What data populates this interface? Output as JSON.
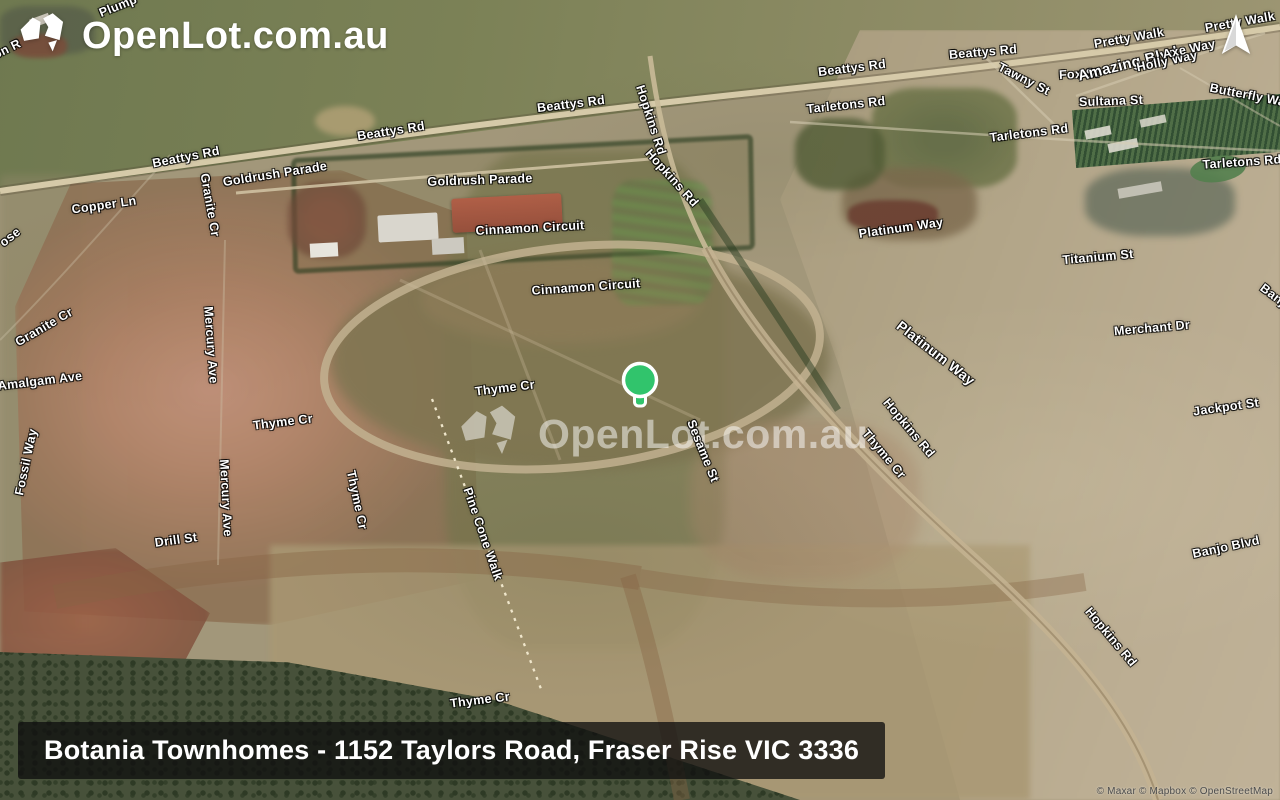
{
  "header": {
    "logo_text": "OpenLot.com.au",
    "logo_icon": "australia-map-icon"
  },
  "compass": {
    "icon": "north-arrow-icon"
  },
  "watermark": {
    "text": "OpenLot.com.au",
    "icon": "australia-map-icon"
  },
  "banner": {
    "text": "Botania Townhomes - 1152 Taylors Road, Fraser Rise VIC 3336"
  },
  "attribution": {
    "text": "© Maxar © Mapbox © OpenStreetMap"
  },
  "marker": {
    "icon": "location-marker",
    "color": "#31c46c",
    "x": 640,
    "y": 380
  },
  "map": {
    "labels": [
      {
        "text": "Plump",
        "x": 118,
        "y": 6,
        "rot": -22
      },
      {
        "text": "on R",
        "x": 7,
        "y": 49,
        "rot": -26
      },
      {
        "text": "Beattys Rd",
        "x": 186,
        "y": 157,
        "rot": -11
      },
      {
        "text": "Beattys Rd",
        "x": 391,
        "y": 131,
        "rot": -9
      },
      {
        "text": "Beattys Rd",
        "x": 571,
        "y": 104,
        "rot": -7
      },
      {
        "text": "Beattys Rd",
        "x": 852,
        "y": 68,
        "rot": -7
      },
      {
        "text": "Beattys Rd",
        "x": 983,
        "y": 52,
        "rot": -5
      },
      {
        "text": "Goldrush Parade",
        "x": 275,
        "y": 174,
        "rot": -9
      },
      {
        "text": "Goldrush Parade",
        "x": 480,
        "y": 180,
        "rot": -2
      },
      {
        "text": "Copper Ln",
        "x": 104,
        "y": 205,
        "rot": -8
      },
      {
        "text": "Granite Cr",
        "x": 210,
        "y": 205,
        "rot": 80
      },
      {
        "text": "Cinnamon Circuit",
        "x": 530,
        "y": 228,
        "rot": -3
      },
      {
        "text": "Cinnamon Circuit",
        "x": 586,
        "y": 287,
        "rot": -4
      },
      {
        "text": "Hopkins Rd",
        "x": 651,
        "y": 120,
        "rot": 72
      },
      {
        "text": "Hopkins Rd",
        "x": 672,
        "y": 178,
        "rot": 48
      },
      {
        "text": "ose",
        "x": 10,
        "y": 237,
        "rot": -38
      },
      {
        "text": "Granite Cr",
        "x": 44,
        "y": 327,
        "rot": -30
      },
      {
        "text": "Amalgam Ave",
        "x": 40,
        "y": 381,
        "rot": -7
      },
      {
        "text": "Mercury Ave",
        "x": 211,
        "y": 345,
        "rot": 86
      },
      {
        "text": "Thyme Cr",
        "x": 283,
        "y": 422,
        "rot": -7
      },
      {
        "text": "Thyme Cr",
        "x": 357,
        "y": 500,
        "rot": 78
      },
      {
        "text": "Thyme Cr",
        "x": 505,
        "y": 388,
        "rot": -7
      },
      {
        "text": "Mercury Ave",
        "x": 226,
        "y": 498,
        "rot": 87
      },
      {
        "text": "Fossil Way",
        "x": 26,
        "y": 462,
        "rot": -78
      },
      {
        "text": "Drill St",
        "x": 176,
        "y": 540,
        "rot": -8
      },
      {
        "text": "Pine Cone Walk",
        "x": 483,
        "y": 534,
        "rot": 71
      },
      {
        "text": "Thyme Cr",
        "x": 480,
        "y": 700,
        "rot": -7
      },
      {
        "text": "Sesame St",
        "x": 703,
        "y": 451,
        "rot": 68
      },
      {
        "text": "Thyme Cr",
        "x": 884,
        "y": 454,
        "rot": 50
      },
      {
        "text": "Hopkins Rd",
        "x": 909,
        "y": 428,
        "rot": 50
      },
      {
        "text": "Platinum Way",
        "x": 901,
        "y": 228,
        "rot": -8
      },
      {
        "text": "Platinum Way",
        "x": 936,
        "y": 353,
        "rot": 38,
        "size": 14
      },
      {
        "text": "Titanium St",
        "x": 1098,
        "y": 257,
        "rot": -5
      },
      {
        "text": "Merchant Dr",
        "x": 1152,
        "y": 328,
        "rot": -5
      },
      {
        "text": "Jackpot St",
        "x": 1226,
        "y": 407,
        "rot": -8
      },
      {
        "text": "Banjo Blvd",
        "x": 1226,
        "y": 547,
        "rot": -12
      },
      {
        "text": "Hopkins Rd",
        "x": 1111,
        "y": 637,
        "rot": 50
      },
      {
        "text": "Banj",
        "x": 1273,
        "y": 295,
        "rot": 37
      },
      {
        "text": "Tarletons Rd",
        "x": 846,
        "y": 105,
        "rot": -6
      },
      {
        "text": "Tarletons Rd",
        "x": 1029,
        "y": 133,
        "rot": -7
      },
      {
        "text": "Tarletons Rd",
        "x": 1242,
        "y": 162,
        "rot": -4
      },
      {
        "text": "Tawny St",
        "x": 1024,
        "y": 79,
        "rot": 27
      },
      {
        "text": "Fox St",
        "x": 1079,
        "y": 74,
        "rot": -3
      },
      {
        "text": "Sultana St",
        "x": 1111,
        "y": 101,
        "rot": -2
      },
      {
        "text": "Amazing Blvd",
        "x": 1128,
        "y": 64,
        "rot": -14,
        "size": 15
      },
      {
        "text": "Holly Way",
        "x": 1167,
        "y": 61,
        "rot": -12
      },
      {
        "text": "Axe Way",
        "x": 1189,
        "y": 49,
        "rot": -12
      },
      {
        "text": "Pretty Walk",
        "x": 1129,
        "y": 38,
        "rot": -10
      },
      {
        "text": "Pretty Walk",
        "x": 1240,
        "y": 22,
        "rot": -10
      },
      {
        "text": "Butterfly Walk",
        "x": 1253,
        "y": 96,
        "rot": 11
      }
    ]
  }
}
